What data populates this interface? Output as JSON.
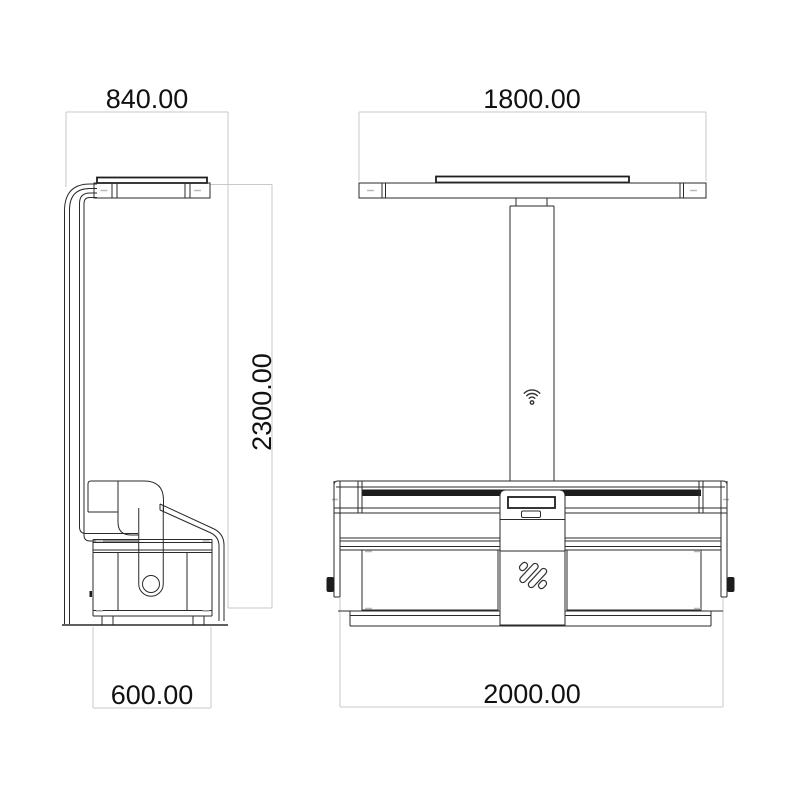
{
  "drawing": {
    "type": "technical-drawing",
    "views": {
      "side_view": {
        "dimensions": {
          "top_width": "840.00",
          "height": "2300.00",
          "bottom_depth": "600.00"
        }
      },
      "front_view": {
        "dimensions": {
          "top_width": "1800.00",
          "bottom_width": "2000.00"
        },
        "icons": {
          "wifi": "wifi-icon",
          "logo": "brand-logo-icon"
        }
      }
    },
    "colors": {
      "background": "#ffffff",
      "line": "#2a2a2a",
      "dimension_line": "#c9c9c9",
      "accent_dark": "#1d1d1d",
      "text": "#111111"
    }
  }
}
